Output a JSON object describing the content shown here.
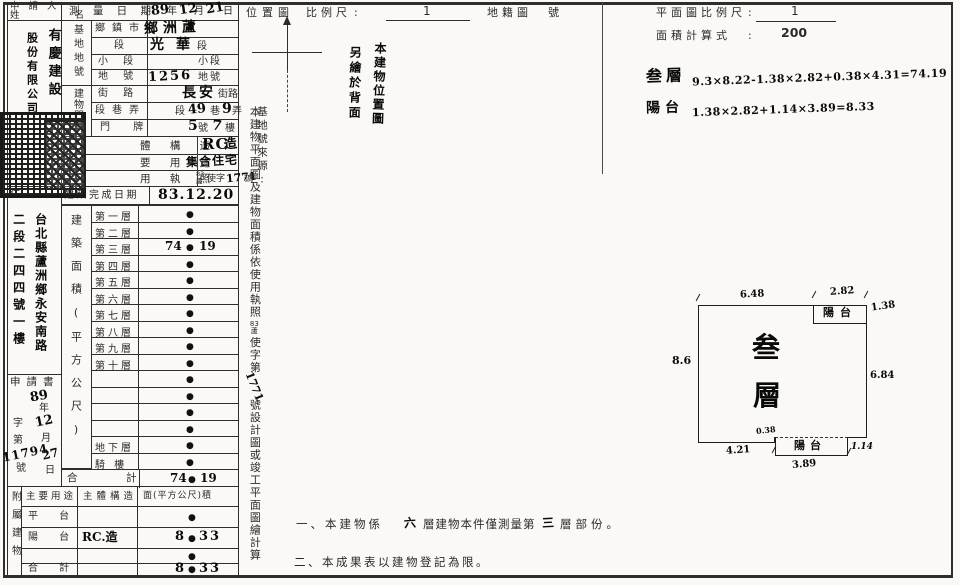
{
  "glyphs": {
    "dot": "●"
  },
  "applicant": {
    "label_line1": "申 請 人",
    "label_line2": "姓 名",
    "name_right_col": "有慶建設",
    "name_left_col": "股份有限公司"
  },
  "survey": {
    "date_label": "測 量 日 期",
    "date_year": "89",
    "date_year_unit": "年",
    "date_month": "12",
    "date_month_unit": "月",
    "date_day": "21",
    "date_day_unit": "日",
    "site_group": "基地地號",
    "building_group": "建物門牌",
    "township_label": "鄉鎮市",
    "township_value": "鄉洲蘆",
    "section_label": "段",
    "section_value": "光華",
    "section_unit": "段",
    "subsection_label": "小 段",
    "subsection_unit": "小段",
    "lot_label": "地 號",
    "lot_value": "1256",
    "lot_unit": "地號",
    "street_label": "街 路",
    "street_value": "長安",
    "street_unit": "街路",
    "lane_label": "段巷弄",
    "lane_seg": "段",
    "lane_v1": "49",
    "lane_alley": "巷",
    "lane_v2": "9",
    "lane_unit": "弄",
    "door_label": "門 牌",
    "door_v1": "5",
    "door_u1": "號",
    "door_v2": "7",
    "door_u2": "樓",
    "structure_label": "體 構 造",
    "structure_latin": "RC",
    "structure_cjk": "造",
    "use_label": "要 用 途",
    "use_value": "集合住宅",
    "license_label": "用 執 照",
    "license_sup": "83",
    "license_sub": "蘆",
    "license_pre": "使字",
    "license_num": "1771",
    "license_unit": "號",
    "completion_label": "建築完成日期",
    "completion_value": "83.12.20"
  },
  "address": {
    "label": "住 址",
    "right_col": "台北縣蘆洲鄉永安南路",
    "left_col": "二段二四四號一樓"
  },
  "application": {
    "label": "申請書",
    "year": "89",
    "year_unit": "年",
    "zi": "字",
    "month": "12",
    "di": "第",
    "month_unit": "月",
    "number": "11794",
    "number_unit": "號",
    "day": "27",
    "day_unit": "日"
  },
  "areas": {
    "group_label": "建築面積(平方公尺)",
    "floors": [
      {
        "label": "第一層",
        "v1": "",
        "v2": ""
      },
      {
        "label": "第二層",
        "v1": "",
        "v2": ""
      },
      {
        "label": "第三層",
        "v1": "74",
        "v2": "19"
      },
      {
        "label": "第四層",
        "v1": "",
        "v2": ""
      },
      {
        "label": "第五層",
        "v1": "",
        "v2": ""
      },
      {
        "label": "第六層",
        "v1": "",
        "v2": ""
      },
      {
        "label": "第七層",
        "v1": "",
        "v2": ""
      },
      {
        "label": "第八層",
        "v1": "",
        "v2": ""
      },
      {
        "label": "第九層",
        "v1": "",
        "v2": ""
      },
      {
        "label": "第十層",
        "v1": "",
        "v2": ""
      },
      {
        "label": "",
        "v1": "",
        "v2": ""
      },
      {
        "label": "",
        "v1": "",
        "v2": ""
      },
      {
        "label": "",
        "v1": "",
        "v2": ""
      },
      {
        "label": "",
        "v1": "",
        "v2": ""
      },
      {
        "label": "地下層",
        "v1": "",
        "v2": ""
      },
      {
        "label": "騎 樓",
        "v1": "",
        "v2": ""
      }
    ],
    "total_l1": "合",
    "total_l2": "計",
    "total_v1": "74",
    "total_v2": "19"
  },
  "annex": {
    "side_label": "附屬建物",
    "col_use": "主要用途",
    "col_structure": "主體構造",
    "col_area": "面(平方公尺)積",
    "rows": [
      {
        "use": "平 台",
        "structure": "",
        "v1": "",
        "v2": ""
      },
      {
        "use": "陽 台",
        "structure": "RC.造",
        "v1": "8",
        "v2": "33"
      },
      {
        "use": "",
        "structure": "",
        "v1": "",
        "v2": ""
      },
      {
        "use": "合 計",
        "structure": "",
        "v1": "8",
        "v2": "33"
      }
    ]
  },
  "middle": {
    "location_map": "位置圖",
    "scale_label": "比例尺",
    "colon": ":",
    "scale_value": "1",
    "cadastral": "地籍圖",
    "number_unit": "號",
    "note_hand_right": "本建物位置圖",
    "note_hand_left": "另繪於背面",
    "site_source": "基地號來源:",
    "statement_p1": "本建物平面圖及建物面積係依使用執照",
    "statement_sup": "83",
    "statement_sub": "蘆",
    "statement_p2": "使字第",
    "statement_num": "1771",
    "statement_p3": "號設計圖或竣工平面圖繪計算"
  },
  "planform": {
    "scale_label": "平面圖比例尺",
    "colon": ":",
    "scale_num": "1",
    "scale_den": "200",
    "calc_label": "面積計算式",
    "f1_label": "叁層",
    "f1": "9.3×8.22-1.38×2.82+0.38×4.31=74.19",
    "f2_label": "陽台",
    "f2": "1.38×2.82+1.14×3.89=8.33"
  },
  "plan": {
    "floor_char1": "叁",
    "floor_char2": "層",
    "balcony_top": "陽台",
    "balcony_bottom": "陽台",
    "dim_top_left": "6.48",
    "dim_top_right": "2.82",
    "dim_balcony_right": "1.38",
    "dim_left": "8.6",
    "dim_right": "6.84",
    "dim_step": "0.38",
    "dim_bottom_left": "4.21",
    "dim_balcony_b_right": "1.14",
    "dim_balcony_b_width": "3.89"
  },
  "notes": {
    "n1_pre": "一、本建物係",
    "n1_floors": "六",
    "n1_mid": "層建物本件僅測量第",
    "n1_num": "三",
    "n1_post": "層部份。",
    "n2": "二、本成果表以建物登記為限。"
  }
}
